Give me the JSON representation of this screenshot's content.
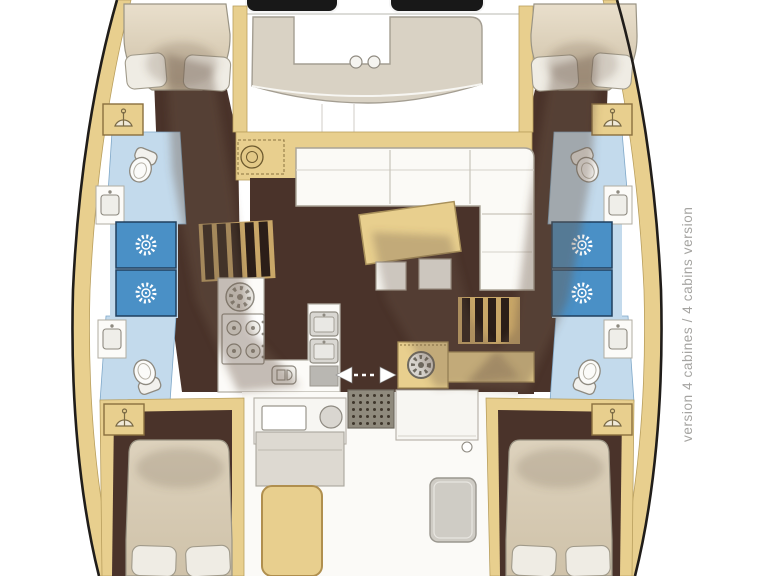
{
  "caption": {
    "text": "version 4 cabines / 4 cabins version"
  },
  "palette": {
    "deck": "#e8cf8e",
    "deckEdge": "#b5954f",
    "floor": "#4a332a",
    "bath": "#c3daec",
    "shower": "#4a90c6",
    "lounge": "#d9d2c4",
    "white": "#fbfaf7",
    "hullLine": "#201d1a",
    "captionColor": "#a5a4a1",
    "shadow": "#6b5544",
    "mat": "#8f8a7d",
    "black": "#181818"
  },
  "icons": {
    "shower": "sunburst-shower-head",
    "toilet": "toilet-top-view",
    "sink": "basin-with-faucet",
    "wardrobe": "clothes-hanger",
    "stove": "four-burner-hob",
    "wheel": "spoked-wheel",
    "sliding_door": "left-right-arrows"
  }
}
